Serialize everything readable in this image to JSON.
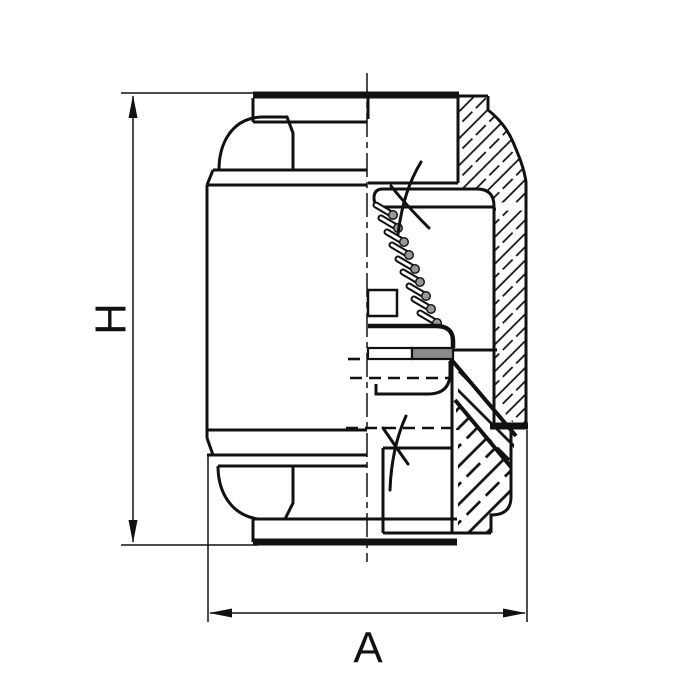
{
  "dimensions": {
    "height_label": "H",
    "width_label": "A"
  },
  "colors": {
    "line": "#111111",
    "seal": "#8a8a8a",
    "spring_tip": "#9b968f",
    "background": "#ffffff"
  }
}
